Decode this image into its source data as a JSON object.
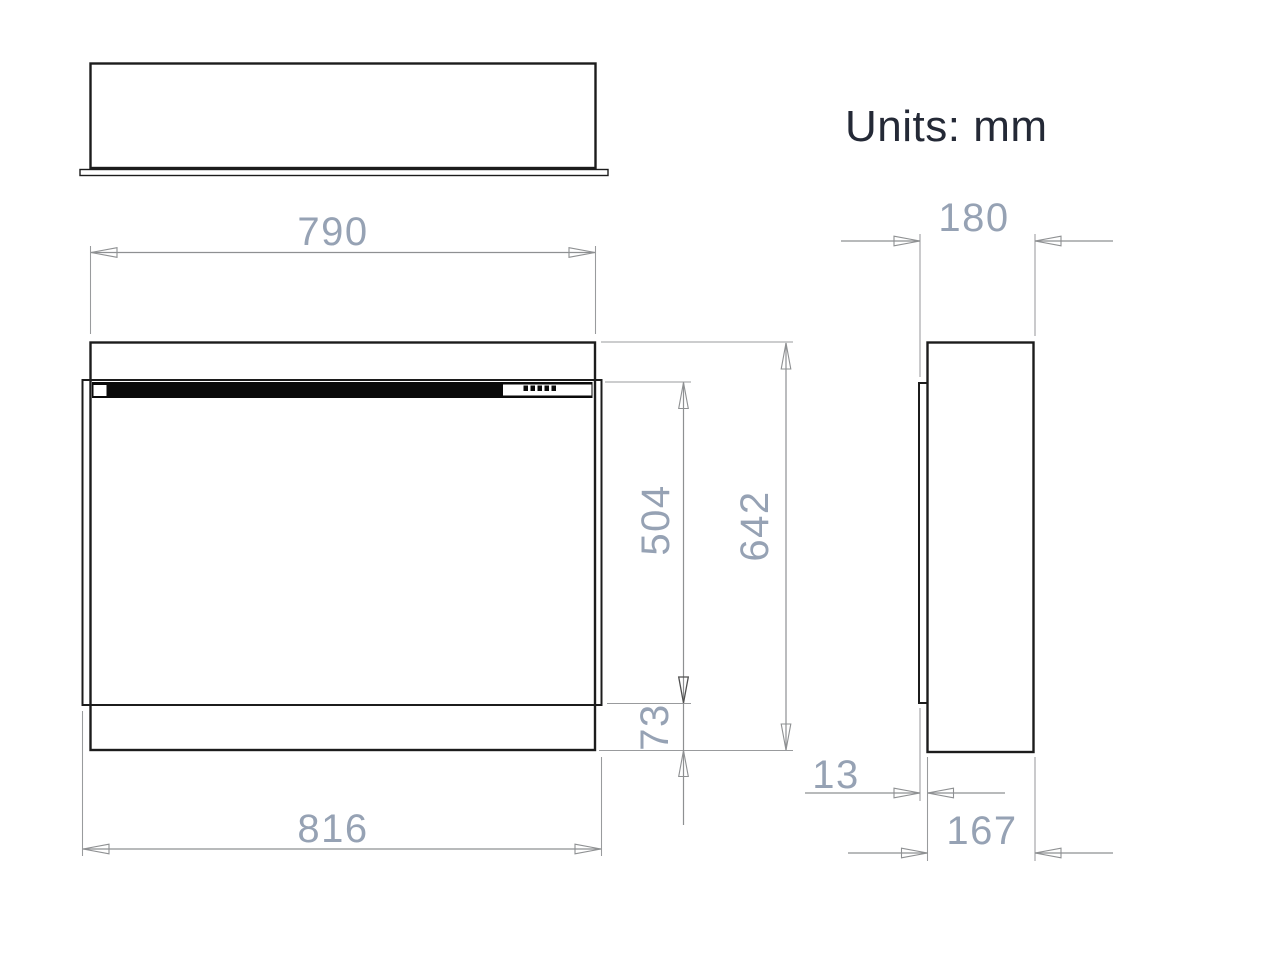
{
  "note": {
    "units": "Units: mm"
  },
  "dimensions": {
    "front_width": "790",
    "overall_width": "816",
    "overall_height": "642",
    "opening_height": "504",
    "base_height": "73",
    "overall_depth": "180",
    "body_depth": "167",
    "front_protrusion": "13"
  },
  "colors": {
    "object_line": "#1c1c1c",
    "dimension_line": "#8e9092",
    "dimension_text": "#96a2b4",
    "note_text": "#242936",
    "strip_fill": "#0a0a0a",
    "background": "#ffffff"
  }
}
